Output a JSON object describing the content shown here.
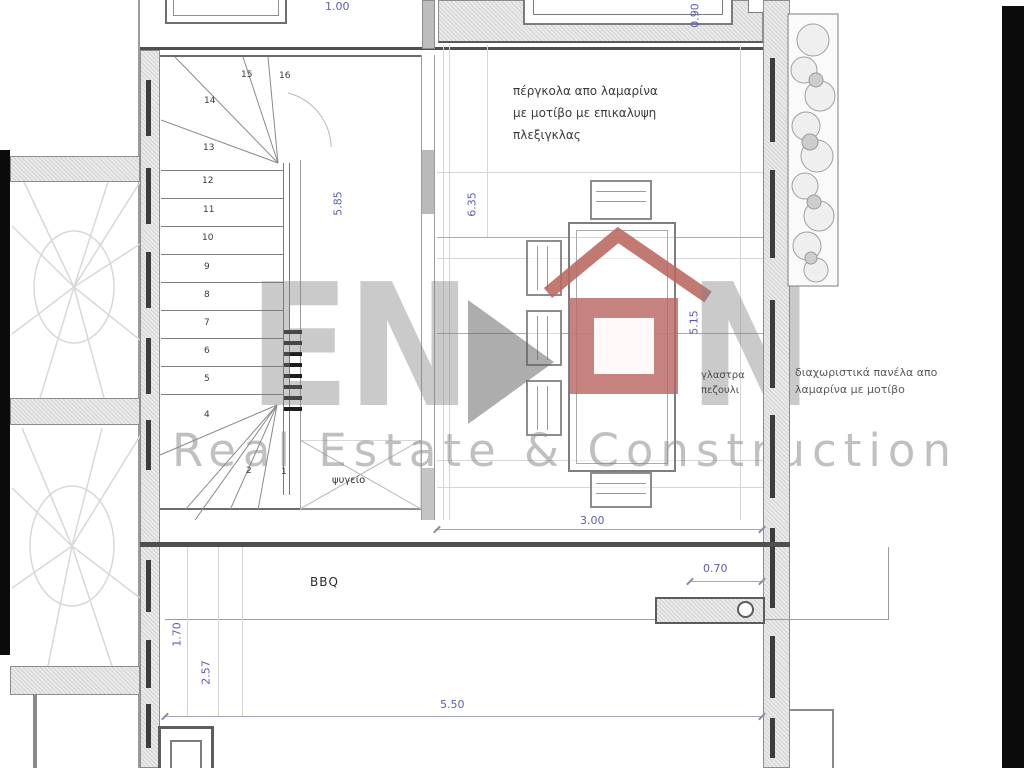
{
  "watermark": {
    "brand_left": "EN",
    "brand_right": "N",
    "tagline": "Real Estate & Construction"
  },
  "labels": {
    "pergola_note_1": "πέργκολα απο λαμαρίνα",
    "pergola_note_2": "με μοτίβο με επικαλυψη",
    "pergola_note_3": "πλεξιγκλας",
    "panel_note_1": "διαχωριστικά πανέλα απο",
    "panel_note_2": "λαμαρίνα με μοτίβο",
    "planter_note_1": "γλαστρα",
    "planter_note_2": "πεζουλι",
    "fridge": "ψυγείο",
    "bbq": "BBQ"
  },
  "dimensions": {
    "top": "1.00",
    "top_right": "0.90",
    "stair_height": "5.85",
    "pergola_height": "6.35",
    "table_height": "5.15",
    "pergola_width": "3.00",
    "gap": "0.70",
    "bottom_width": "5.50",
    "left_height_1": "1.70",
    "left_height_2": "2.57"
  },
  "stair_numbers": [
    "16",
    "15",
    "14",
    "13",
    "12",
    "11",
    "10",
    "9",
    "8",
    "7",
    "6",
    "5",
    "4",
    "2",
    "1"
  ],
  "colors": {
    "dimension_blue": "#5d5db5",
    "logo_red": "#b8675f",
    "watermark_gray": "#8a8a8a",
    "wall_dark": "#4f4f4f"
  }
}
